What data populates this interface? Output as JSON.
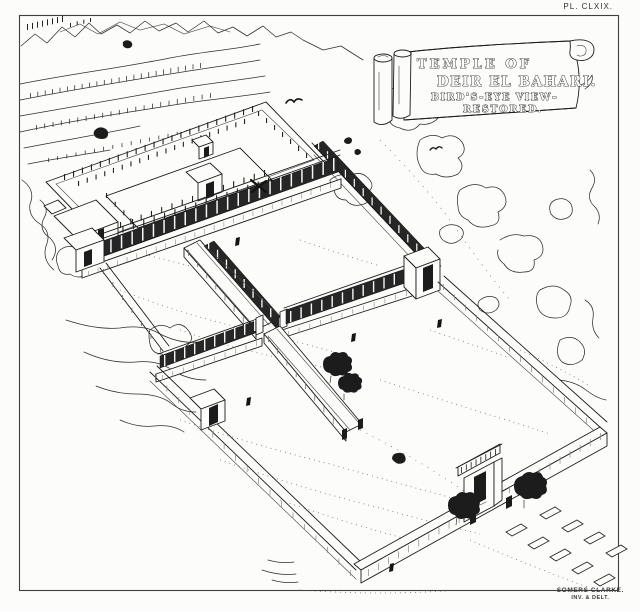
{
  "plate_label": "PL. CLXIX.",
  "scroll_banner": {
    "line1": "TEMPLE OF",
    "line2": "DEIR EL BAHARI.",
    "line3": "BIRD'S-EYE VIEW–",
    "line4": "RESTORED."
  },
  "signature": {
    "line1": "SOMERS CLARKE.",
    "line2": "INV. & DELT."
  },
  "colors": {
    "ink": "#1c1c1c",
    "paper": "#fcfcfb",
    "frame": "#3f3f3f"
  }
}
